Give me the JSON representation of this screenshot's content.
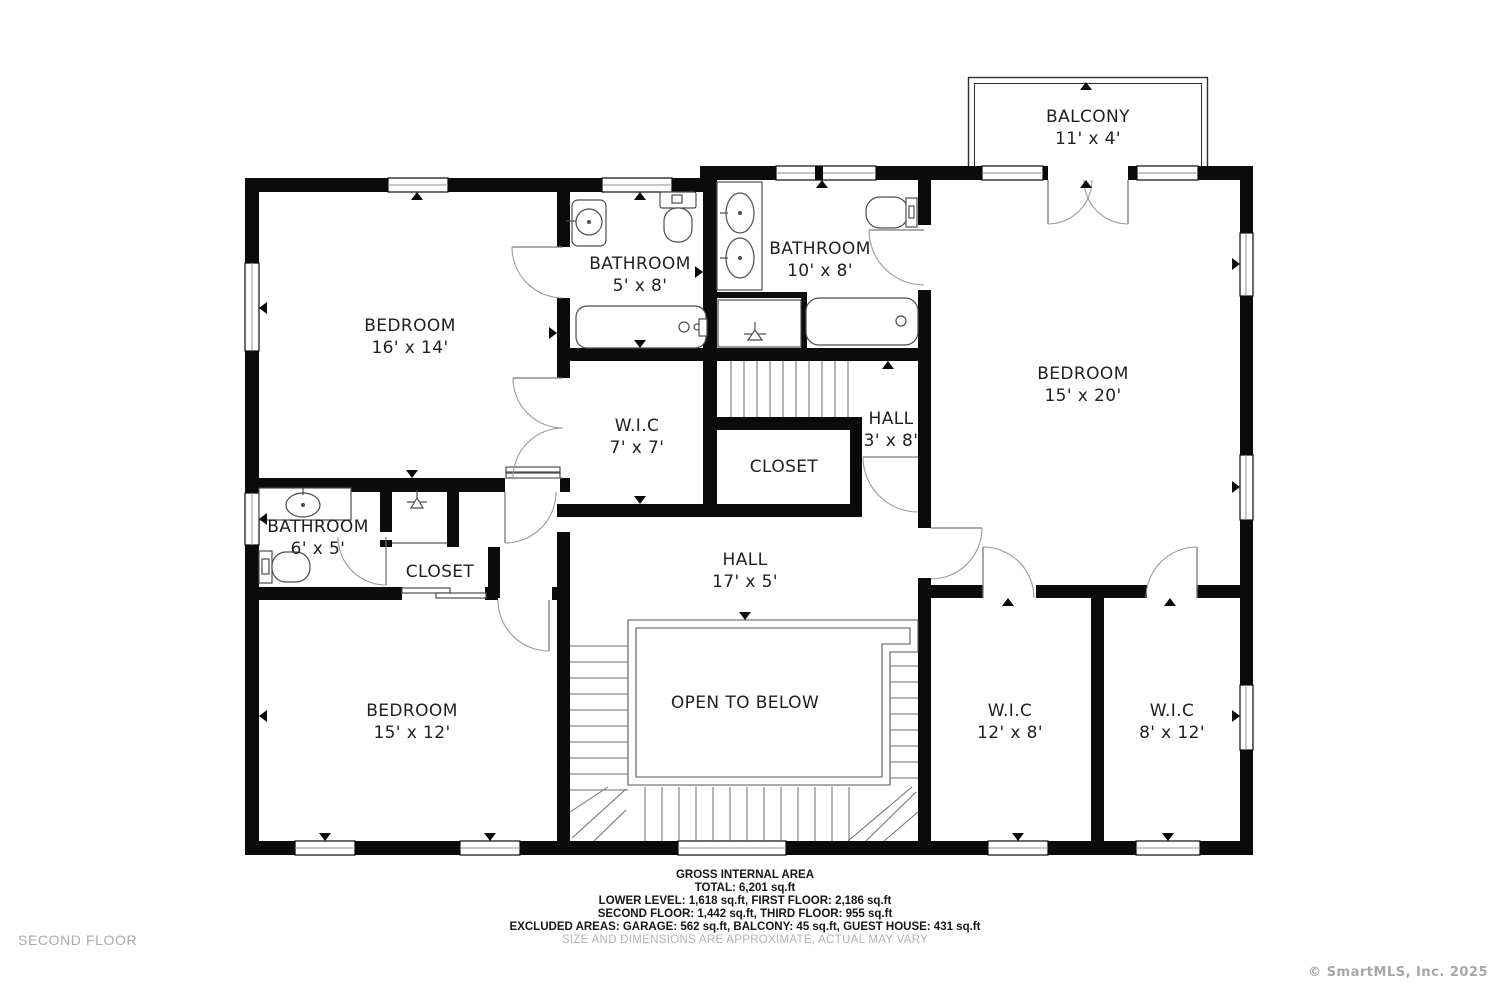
{
  "plan": {
    "floor_label": "SECOND FLOOR",
    "copyright": "© SmartMLS, Inc.  2025",
    "rooms": [
      {
        "name": "BALCONY",
        "dims": "11' x 4'"
      },
      {
        "name": "BATHROOM",
        "dims": "5' x 8'"
      },
      {
        "name": "BATHROOM",
        "dims": "10' x 8'"
      },
      {
        "name": "BEDROOM",
        "dims": "16' x 14'"
      },
      {
        "name": "BEDROOM",
        "dims": "15' x 20'"
      },
      {
        "name": "W.I.C",
        "dims": "7' x 7'"
      },
      {
        "name": "HALL",
        "dims": "3' x 8'"
      },
      {
        "name": "CLOSET",
        "dims": ""
      },
      {
        "name": "BATHROOM",
        "dims": "6' x 5'"
      },
      {
        "name": "CLOSET",
        "dims": ""
      },
      {
        "name": "HALL",
        "dims": "17' x 5'"
      },
      {
        "name": "OPEN TO BELOW",
        "dims": ""
      },
      {
        "name": "BEDROOM",
        "dims": "15' x 12'"
      },
      {
        "name": "W.I.C",
        "dims": "12' x 8'"
      },
      {
        "name": "W.I.C",
        "dims": "8' x 12'"
      }
    ],
    "footer": {
      "line1": "GROSS INTERNAL AREA",
      "line2": "TOTAL: 6,201 sq.ft",
      "line3": "LOWER LEVEL: 1,618 sq.ft, FIRST FLOOR: 2,186 sq.ft",
      "line4": "SECOND FLOOR: 1,442 sq.ft, THIRD FLOOR: 955 sq.ft",
      "line5": "EXCLUDED AREAS: GARAGE: 562 sq.ft, BALCONY: 45 sq.ft, GUEST HOUSE: 431 sq.ft",
      "disclaimer": "SIZE AND DIMENSIONS ARE APPROXIMATE, ACTUAL MAY VARY"
    },
    "colors": {
      "wall": "#0b0b0b",
      "line": "#4d4d4d",
      "muted": "#ababab"
    }
  }
}
